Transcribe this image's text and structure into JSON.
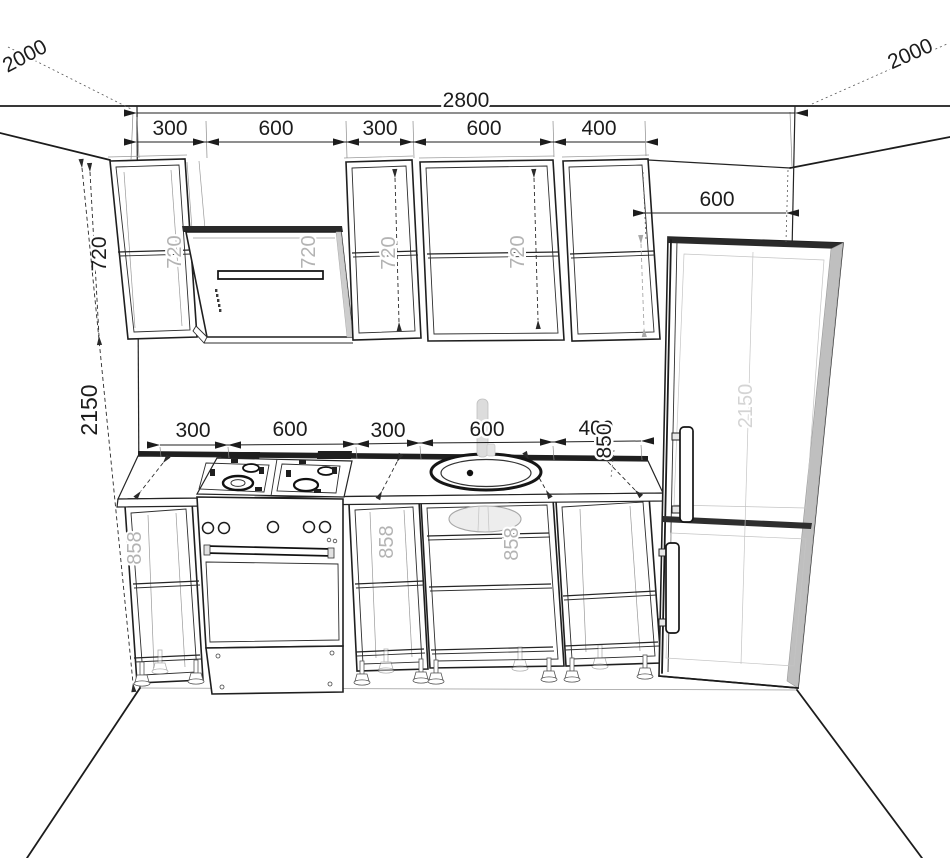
{
  "colors": {
    "ink": "#1c1c1c",
    "gray_label": "#b3b3b3",
    "faint_label": "#d4d4d4",
    "metal_gray": "#bfbfbf",
    "background": "#ffffff"
  },
  "dimensions": {
    "left_wall_depth": "2000",
    "right_wall_depth": "2000",
    "total_width": "2800",
    "upper_cabinet_widths": [
      "300",
      "600",
      "300",
      "600",
      "400"
    ],
    "base_cabinet_widths": [
      "300",
      "600",
      "300",
      "600",
      "400"
    ],
    "fridge_width": "600",
    "upper_cabinet_height": "720",
    "upper_inner_heights": [
      "720",
      "720",
      "720",
      "720"
    ],
    "total_height": "2150",
    "worktop_height": "850",
    "base_inner_heights": [
      "858",
      "858",
      "858"
    ],
    "fridge_height": "2150"
  }
}
